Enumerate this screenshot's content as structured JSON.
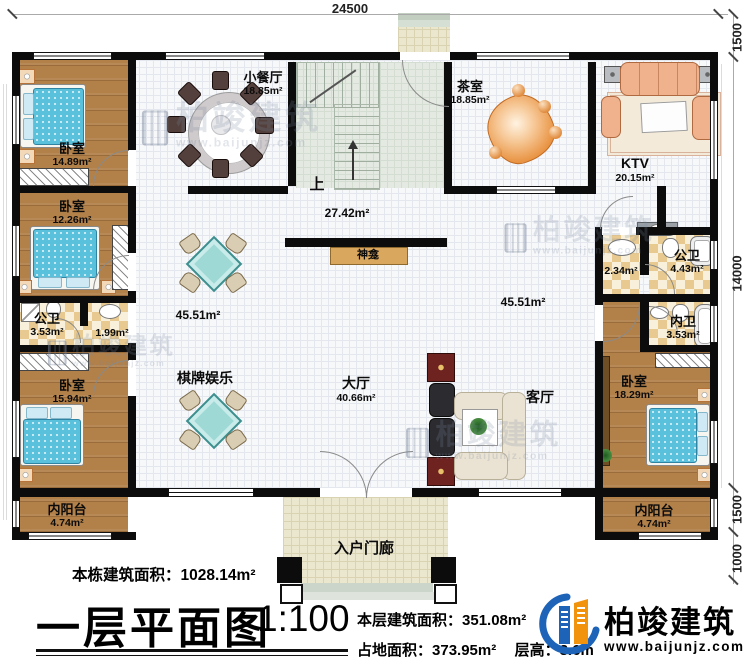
{
  "plan": {
    "dimensions": {
      "top": "24500",
      "right": [
        "1500",
        "14000",
        "1500",
        "1000"
      ]
    },
    "stairs_up_label": "上"
  },
  "rooms": {
    "bedroom_nw": {
      "name": "卧室",
      "area": "14.89m²"
    },
    "bedroom_w": {
      "name": "卧室",
      "area": "12.26m²"
    },
    "bath_w": {
      "name": "公卫",
      "area": "3.53m²"
    },
    "vanity_w": {
      "area": "1.99m²"
    },
    "bedroom_sw": {
      "name": "卧室",
      "area": "15.94m²"
    },
    "balcony_w": {
      "name": "内阳台",
      "area": "4.74m²"
    },
    "dining": {
      "name": "小餐厅",
      "area": "18.85m²"
    },
    "tea": {
      "name": "茶室",
      "area": "18.85m²"
    },
    "ktv": {
      "name": "KTV",
      "area": "20.15m²"
    },
    "vanity_e": {
      "area": "2.34m²"
    },
    "bath_e": {
      "name": "公卫",
      "area": "4.43m²"
    },
    "bath_inner": {
      "name": "内卫",
      "area": "3.53m²"
    },
    "bedroom_se": {
      "name": "卧室",
      "area": "18.29m²"
    },
    "balcony_e": {
      "name": "内阳台",
      "area": "4.74m²"
    },
    "hall": {
      "name": "大厅",
      "area": "40.66m²"
    },
    "games": {
      "name": "棋牌娱乐"
    },
    "living": {
      "name": "客厅"
    },
    "shrine": {
      "name": "神龛"
    },
    "porch": {
      "name": "入户门廊"
    },
    "open_upper": {
      "area": "27.42m²"
    },
    "open_left": {
      "area": "45.51m²"
    },
    "open_right": {
      "area": "45.51m²"
    }
  },
  "title_block": {
    "building_area_label": "本栋建筑面积：",
    "building_area_value": "1028.14m²",
    "plan_title": "一层平面图",
    "scale": "1:100",
    "floor_area_label": "本层建筑面积：",
    "floor_area_value": "351.08m²",
    "site_area_label": "占地面积：",
    "site_area_value": "373.95m²",
    "floor_height_label": "层高：",
    "floor_height_value": "3.6m"
  },
  "brand": {
    "name": "柏竣建筑",
    "website": "www.baijunjz.com"
  },
  "watermark": {
    "name": "柏竣建筑",
    "website": "www.baijunjz.com"
  }
}
